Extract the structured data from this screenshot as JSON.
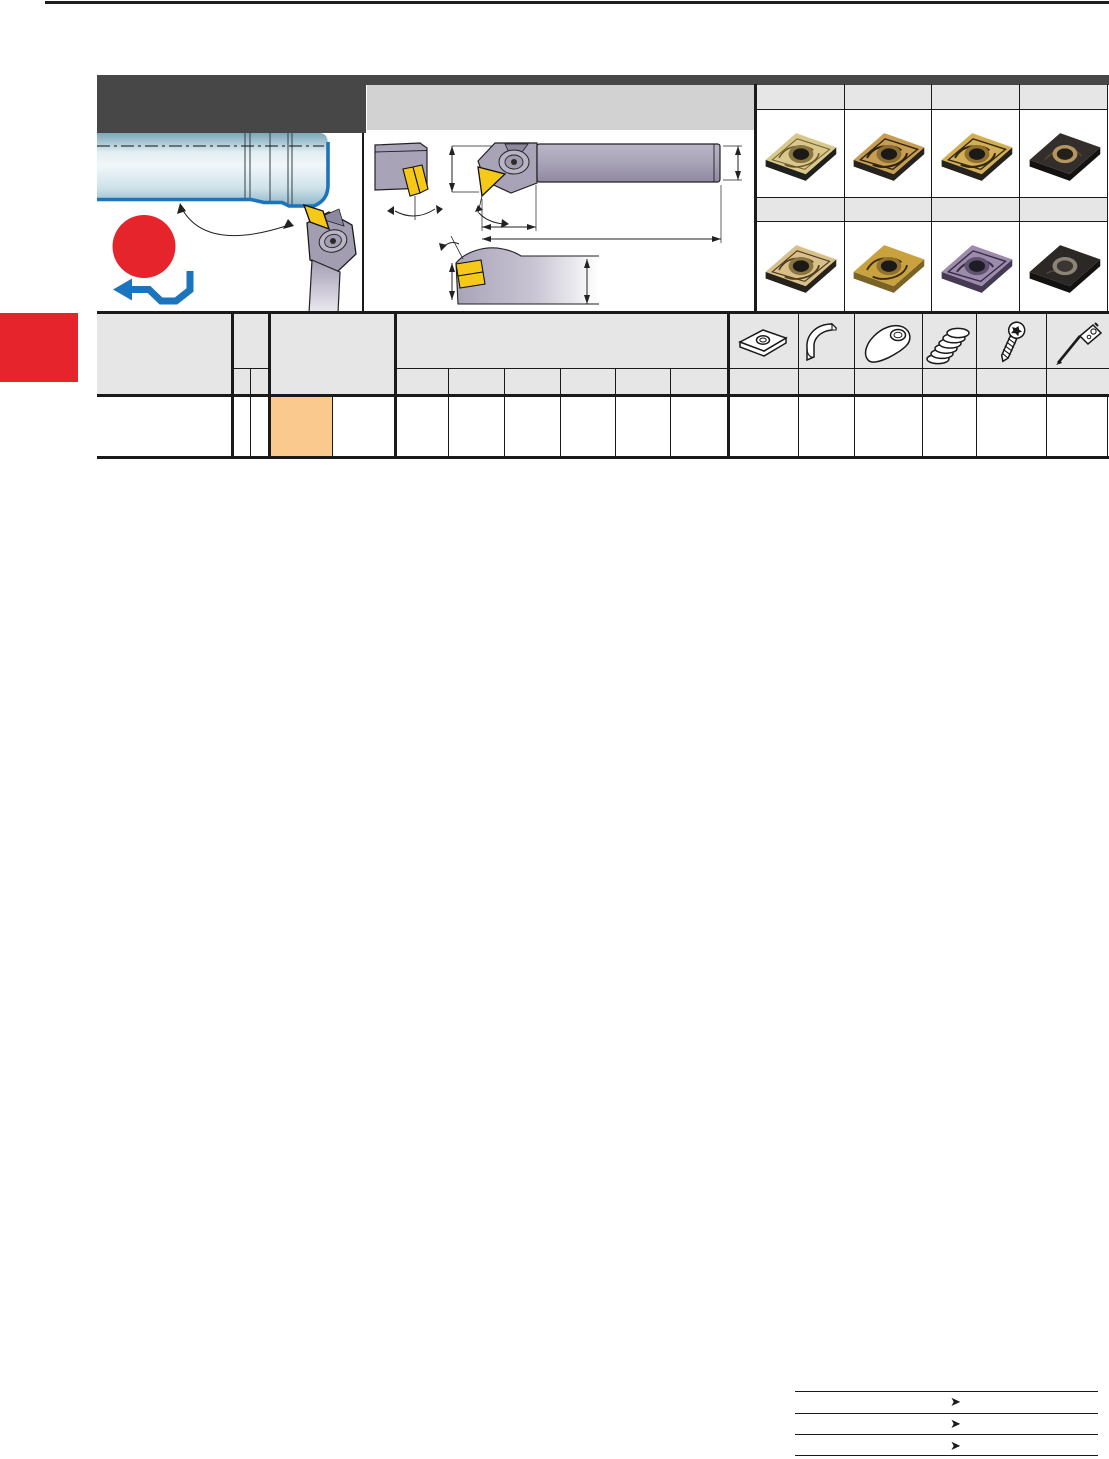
{
  "page": {
    "background": "#ffffff",
    "rule_color": "#1e1e1e"
  },
  "header": {
    "dark_color": "#474747",
    "light_color": "#d2d2d2",
    "dark_block_name": "series-title-block",
    "light_bar_name": "holder-drawing-title-bar"
  },
  "application_panel": {
    "name": "external-profiling-operation-diagram",
    "workpiece_fill_top": "#7ea6ba",
    "workpiece_fill_mid": "#eef5f8",
    "workpiece_fill_bottom": "#8fb5c6",
    "contour_color": "#1b74bc",
    "holder_body_color": "#a39db2",
    "insert_color": "#f6c818",
    "feed_icon": {
      "circle_color": "#e6242c",
      "arrow_color": "#1b74bc"
    }
  },
  "holder_drawing_panel": {
    "name": "toolholder-dimension-drawings",
    "body_color": "#a9a3b8",
    "insert_color": "#f6c818",
    "line_color": "#222222",
    "views": [
      "end-view",
      "side-view",
      "top-view"
    ]
  },
  "insert_grid": {
    "columns": 4,
    "strip_color": "#e6e6e6",
    "rows": [
      {
        "inserts": [
          {
            "name": "insert-photo-tan",
            "face": "#d9c88c",
            "side": "#20201d",
            "pattern": "#6b5526",
            "hole": "#8a7440",
            "bore": "#1c1a17"
          },
          {
            "name": "insert-photo-bronze",
            "face": "#c89d52",
            "side": "#26221c",
            "pattern": "#2e2414",
            "hole": "#8a6e34",
            "bore": "#1c1a17"
          },
          {
            "name": "insert-photo-gold",
            "face": "#d2ae55",
            "side": "#26221c",
            "pattern": "#332812",
            "hole": "#8f7030",
            "bore": "#1c1a17"
          },
          {
            "name": "insert-photo-black-tan",
            "face": "#332e2b",
            "side": "#141210",
            "pattern": "#57452c",
            "hole": "#b49560",
            "bore": "#242019"
          }
        ]
      },
      {
        "inserts": [
          {
            "name": "insert-photo-tan-2",
            "face": "#d9c08a",
            "side": "#26221c",
            "pattern": "#4f3d1e",
            "hole": "#8a7440",
            "bore": "#1c1a17"
          },
          {
            "name": "insert-photo-gold-2",
            "face": "#c9a23f",
            "side": "#7a6324",
            "pattern": "#3a2d10",
            "hole": "#8f7030",
            "bore": "#1c1a17"
          },
          {
            "name": "insert-photo-violet",
            "face": "#9d8bad",
            "side": "#463a52",
            "pattern": "#352b42",
            "hole": "#5e5470",
            "bore": "#201c26"
          },
          {
            "name": "insert-photo-black-2",
            "face": "#2b2825",
            "side": "#131211",
            "pattern": "#4a4540",
            "hole": "#8c8478",
            "bore": "#3a3733"
          }
        ]
      }
    ]
  },
  "parts_table": {
    "header_color": "#e6e6e6",
    "highlight_color": "#f9c98d",
    "border_color": "#1a1a1a",
    "spare_part_icons": [
      "shim-icon",
      "shim-sleeve-icon",
      "clamp-icon",
      "spring-icon",
      "screw-icon",
      "wrench-icon"
    ],
    "order_columns": 6,
    "data_rows": 1
  },
  "side_tab": {
    "color": "#e6242c",
    "name": "chapter-index-tab"
  },
  "footer": {
    "arrow_glyph": "➤",
    "line_color": "#222222",
    "reference_rows": 3
  }
}
